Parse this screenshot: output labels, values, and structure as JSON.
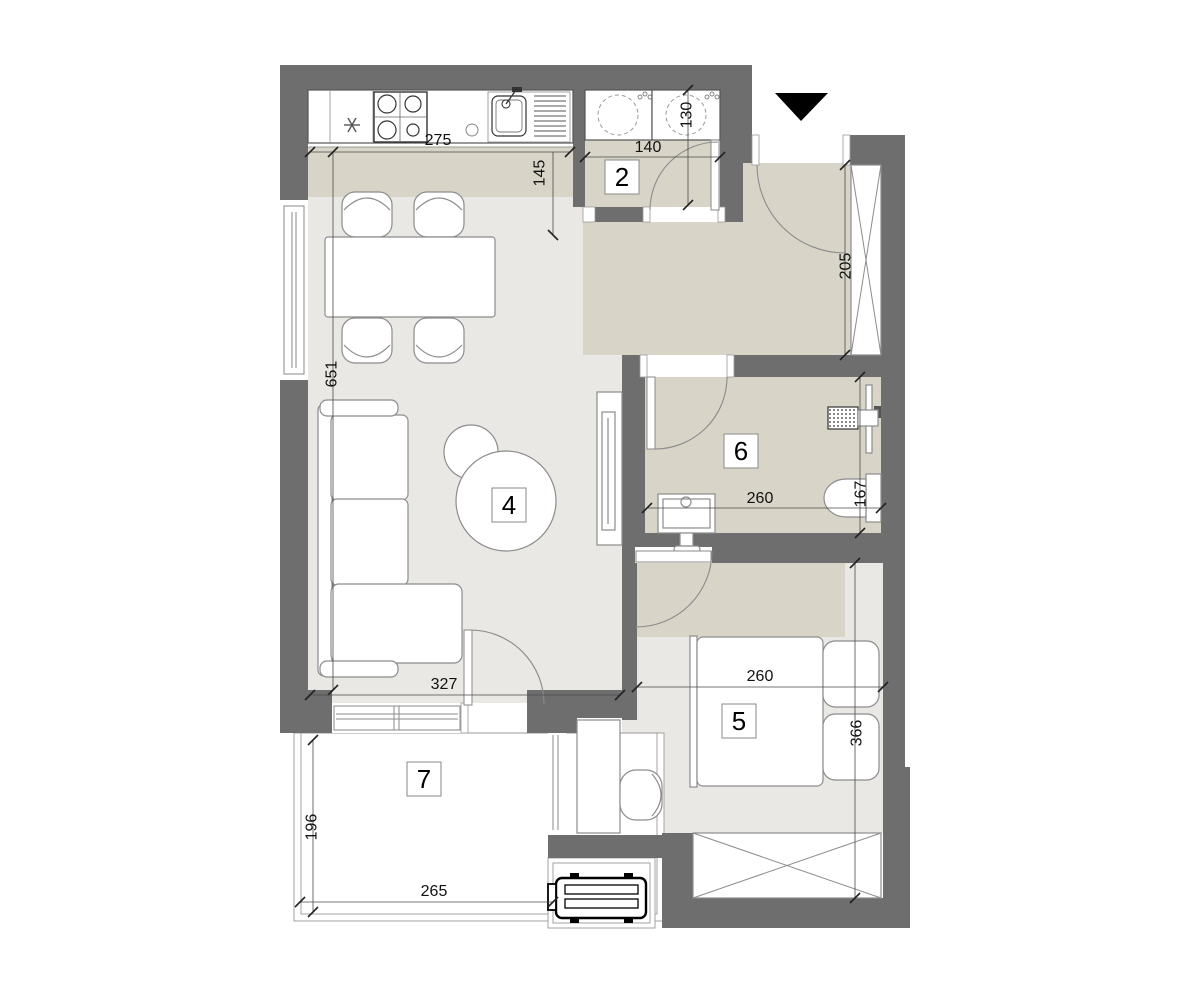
{
  "plan": {
    "type": "apartment-floor-plan",
    "rooms": [
      {
        "label": "2"
      },
      {
        "label": "4"
      },
      {
        "label": "5"
      },
      {
        "label": "6"
      },
      {
        "label": "7"
      }
    ],
    "dimensions": {
      "kitchen_width": "275",
      "kitchen_depth": "145",
      "room2_width": "140",
      "room2_depth": "130",
      "hall_length": "205",
      "living_length": "651",
      "living_width": "327",
      "bath_width": "260",
      "bath_depth": "167",
      "bedroom_width": "260",
      "bedroom_length": "366",
      "balcony_depth": "196",
      "balcony_width": "265"
    },
    "colors": {
      "wall": "#6e6e6e",
      "wet_zone_floor": "#d8d5c8",
      "room_floor": "#e9e8e4",
      "entrance_marker": "#000000"
    },
    "icons": [
      "entrance-arrow-icon",
      "fridge-icon",
      "stove-icon",
      "sink-icon",
      "washing-machine-icon",
      "dryer-icon",
      "toilet-icon",
      "washbasin-icon",
      "towel-radiator-icon",
      "heater-icon",
      "ac-unit-icon"
    ]
  }
}
